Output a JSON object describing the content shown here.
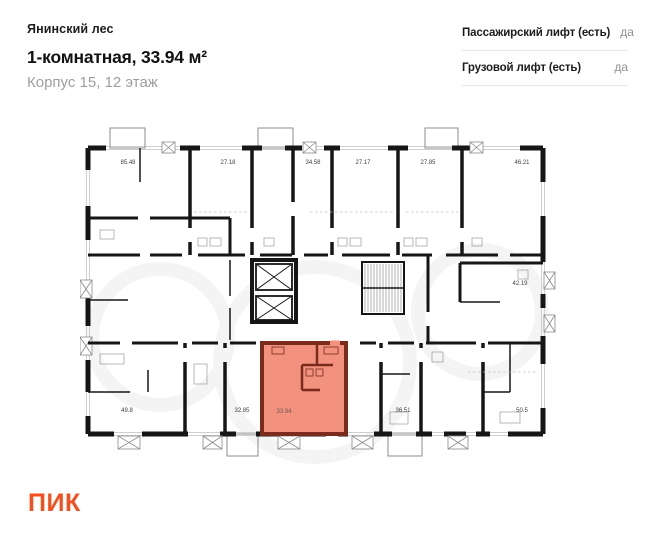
{
  "header": {
    "project_name": "Янинский лес",
    "listing_title": "1-комнатная, 33.94 м²",
    "listing_subtitle": "Корпус 15, 12 этаж"
  },
  "attributes": {
    "rows": [
      {
        "label": "Пассажирский лифт (есть)",
        "value": "да"
      },
      {
        "label": "Грузовой лифт (есть)",
        "value": "да"
      }
    ]
  },
  "floorplan": {
    "highlighted_unit": {
      "area": "33.94"
    },
    "top_row_areas": [
      "85.48",
      "27.18",
      "34.58",
      "27.17",
      "27.85",
      "46.21"
    ],
    "middle_areas": [
      "42.19"
    ],
    "bottom_row_areas": [
      "49.8",
      "32.85",
      "36.51",
      "50.5"
    ]
  },
  "footer": {
    "logo_text": "ПИК"
  },
  "colors": {
    "highlight_fill": "#F2917E",
    "highlight_wall": "#7A2B1B",
    "wall": "#161616",
    "brand_orange": "#F64F1E"
  }
}
